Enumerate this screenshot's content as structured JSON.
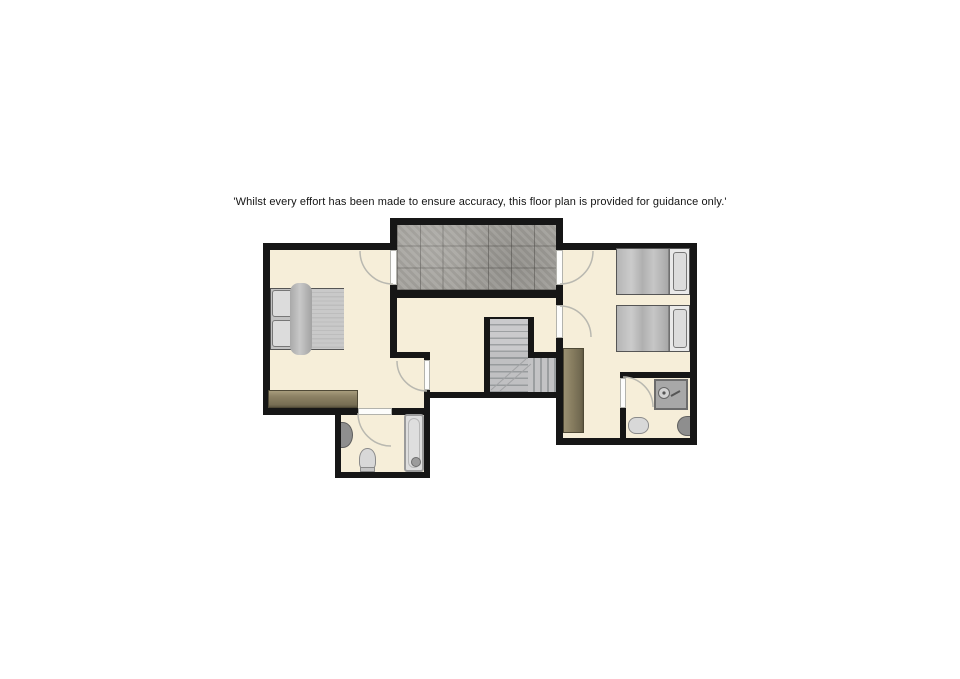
{
  "disclaimer": "'Whilst every effort has been made to ensure accuracy, this floor plan is provided for guidance only.'",
  "palette": {
    "background": "#ffffff",
    "wall": "#161616",
    "floor": "#f6eed9",
    "balcony_tile": "#a4a29d",
    "stairs": "#c2c2c4",
    "wardrobe_wood": "#8c8164",
    "bed_linen": "#c2c2c2",
    "fixture_light": "#d8d8d8",
    "fixture_dark": "#8e8e8e",
    "door_swing": "#b9b8b0"
  },
  "fixtures": {
    "balcony": [
      "tiled-floor"
    ],
    "bedroom_left": [
      "double-bed",
      "wardrobe"
    ],
    "bedroom_right": [
      "single-bed",
      "single-bed",
      "wardrobe"
    ],
    "bathroom_center": [
      "bathtub",
      "toilet",
      "pedestal-sink"
    ],
    "bathroom_right": [
      "shower",
      "toilet",
      "sink"
    ],
    "landing": [
      "staircase"
    ]
  }
}
